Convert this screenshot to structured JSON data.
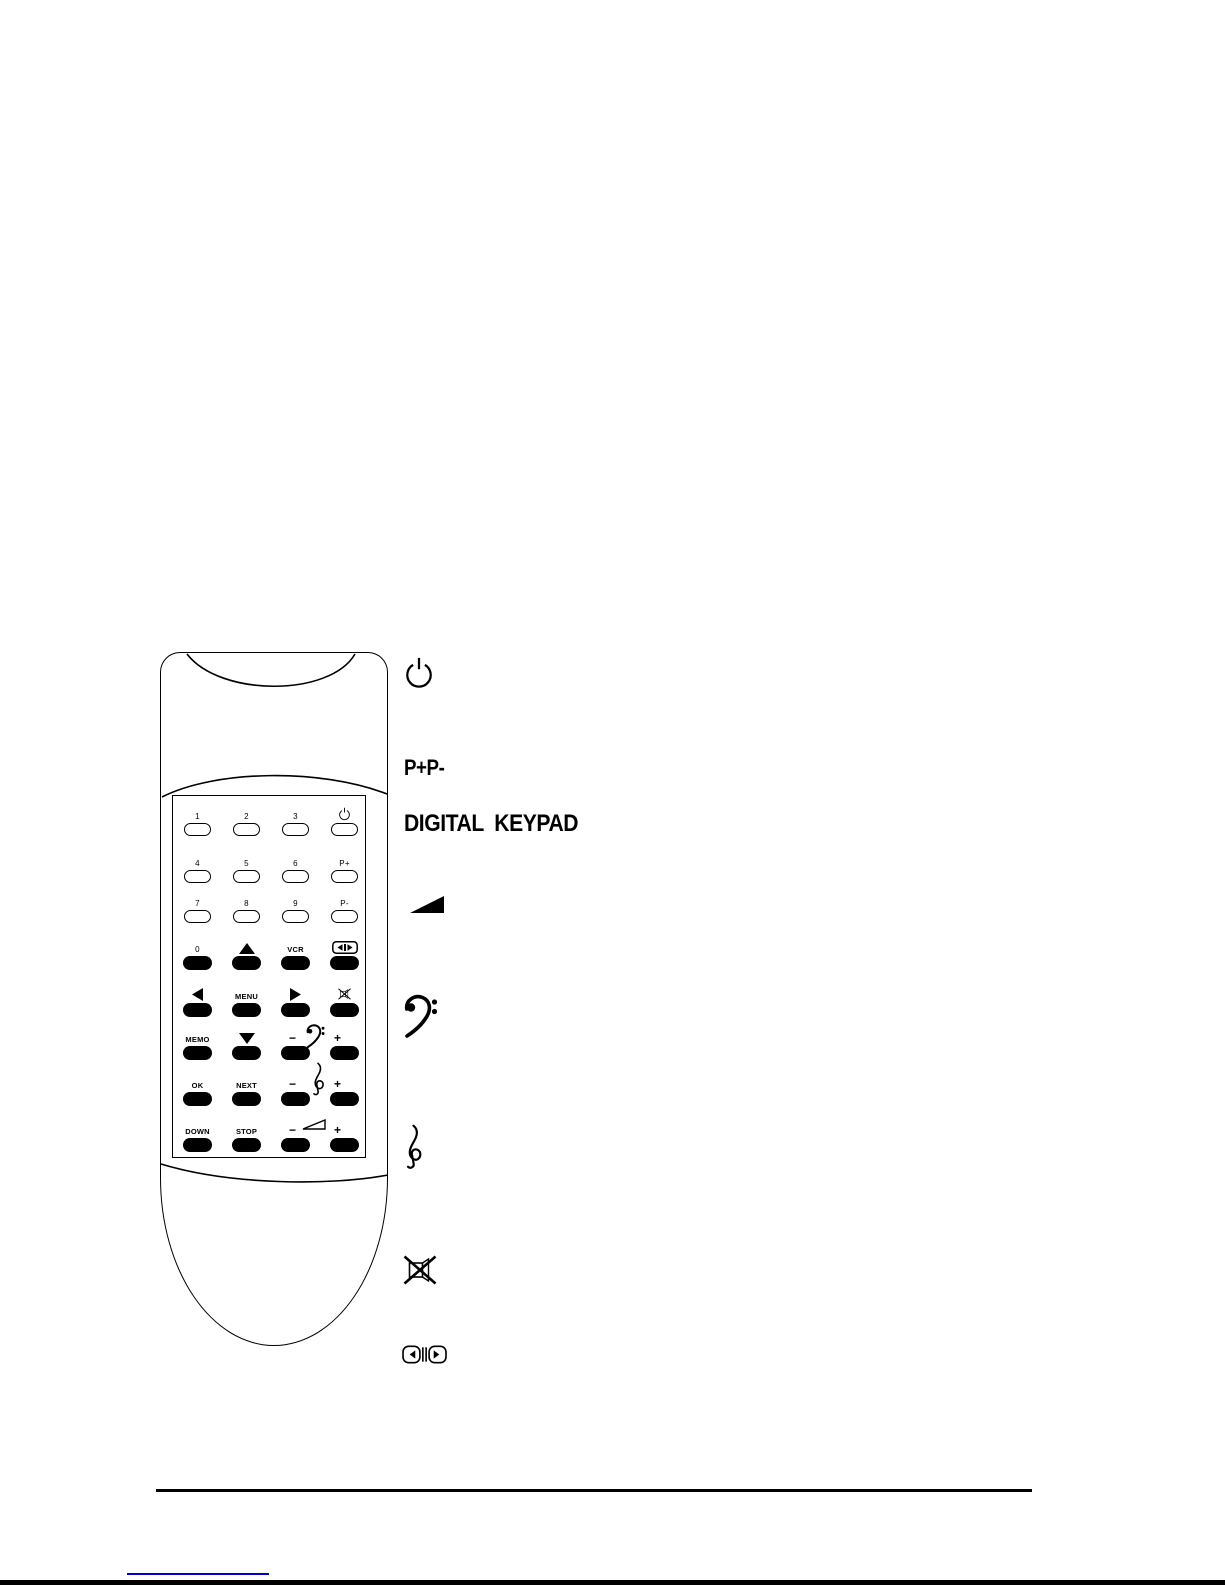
{
  "colors": {
    "ink": "#000000",
    "paper": "#ffffff",
    "link_blue": "#0000cc"
  },
  "keypad": {
    "rows": [
      {
        "style": "white",
        "cells": [
          {
            "label": "1"
          },
          {
            "label": "2"
          },
          {
            "label": "3"
          },
          {
            "icon": "power-icon"
          }
        ]
      },
      {
        "style": "white",
        "cells": [
          {
            "label": "4"
          },
          {
            "label": "5"
          },
          {
            "label": "6"
          },
          {
            "label": "P+"
          }
        ]
      },
      {
        "style": "white",
        "cells": [
          {
            "label": "7"
          },
          {
            "label": "8"
          },
          {
            "label": "9"
          },
          {
            "label": "P-"
          }
        ]
      },
      {
        "style": "black",
        "cells": [
          {
            "label": "0"
          },
          {
            "icon": "arrow-up-icon"
          },
          {
            "label": "VCR"
          },
          {
            "icon": "av-swap-icon"
          }
        ]
      },
      {
        "style": "black",
        "cells": [
          {
            "icon": "arrow-left-icon"
          },
          {
            "label": "MENU"
          },
          {
            "icon": "arrow-right-icon"
          },
          {
            "icon": "mute-icon"
          }
        ]
      },
      {
        "style": "black",
        "between_icon": "bass-clef-icon",
        "cells": [
          {
            "label": "MEMO"
          },
          {
            "icon": "arrow-down-icon"
          },
          {
            "label": "−"
          },
          {
            "label": "+"
          }
        ]
      },
      {
        "style": "black",
        "between_icon": "treble-clef-icon",
        "cells": [
          {
            "label": "OK"
          },
          {
            "label": "NEXT"
          },
          {
            "label": "−"
          },
          {
            "label": "+"
          }
        ]
      },
      {
        "style": "black",
        "between_icon": "volume-icon",
        "cells": [
          {
            "label": "DOWN"
          },
          {
            "label": "STOP"
          },
          {
            "label": "−"
          },
          {
            "label": "+"
          }
        ]
      }
    ]
  },
  "legend": {
    "items": [
      {
        "icon": "power-icon"
      },
      {
        "text": "P+P-"
      },
      {
        "text": "DIGITAL  KEYPAD"
      },
      {
        "icon": "volume-icon"
      },
      {
        "icon": "bass-clef-icon"
      },
      {
        "icon": "treble-clef-icon"
      },
      {
        "icon": "mute-icon"
      },
      {
        "icon": "av-swap-icon"
      }
    ]
  }
}
